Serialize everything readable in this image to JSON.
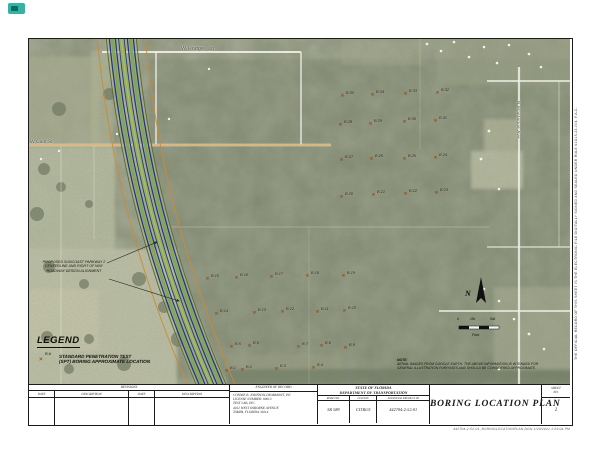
{
  "map": {
    "road_labels": {
      "top": "W Hodges Ln.",
      "left": "W Cain St",
      "right_vertical": "N Montague Ave"
    },
    "annotation": {
      "lines": [
        "PROPOSED SUNCOAST PARKWAY 2",
        "CENTERLINE AND RIGHT OF WAY",
        "ROADWAY DESIGN ALIGNMENT"
      ]
    },
    "legend": {
      "title": "LEGEND",
      "symbol_icon": "×",
      "symbol_label": "B-#",
      "desc_line1": "STANDARD PENETRATION TEST",
      "desc_line2": "(SPT) BORING APPROXIMATE LOCATION"
    },
    "north_label": "N",
    "scale_bar": {
      "ticks": [
        "0",
        "250",
        "500"
      ],
      "unit": "Feet"
    },
    "note": {
      "heading": "NOTE:",
      "line1": "AERIAL IMAGES FROM GOOGLE EARTH. THE ABOVE INFORMATION IS INTENDED FOR",
      "line2": "GENERAL ILLUSTRATION PURPOSES AND SHOULD BE CONSIDERED APPROXIMATE."
    },
    "colors": {
      "aerial_base": "#8a9078",
      "corridor_navy": "#27357c",
      "corridor_green": "#7ea45a",
      "right_of_way_orange": "#cd8a36",
      "marker_orange": "#a8571e"
    },
    "borings": [
      {
        "id": "B-1",
        "x": 198,
        "y": 333
      },
      {
        "id": "B-2",
        "x": 214,
        "y": 332
      },
      {
        "id": "B-3",
        "x": 248,
        "y": 331
      },
      {
        "id": "B-4",
        "x": 285,
        "y": 330
      },
      {
        "id": "B-5",
        "x": 203,
        "y": 309
      },
      {
        "id": "B-6",
        "x": 221,
        "y": 308
      },
      {
        "id": "B-7",
        "x": 270,
        "y": 309
      },
      {
        "id": "B-8",
        "x": 293,
        "y": 308
      },
      {
        "id": "B-9",
        "x": 317,
        "y": 310
      },
      {
        "id": "B-10",
        "x": 316,
        "y": 273
      },
      {
        "id": "B-11",
        "x": 289,
        "y": 274
      },
      {
        "id": "B-12",
        "x": 254,
        "y": 274
      },
      {
        "id": "B-13",
        "x": 226,
        "y": 275
      },
      {
        "id": "B-14",
        "x": 188,
        "y": 276
      },
      {
        "id": "B-15",
        "x": 179,
        "y": 241
      },
      {
        "id": "B-16",
        "x": 208,
        "y": 240
      },
      {
        "id": "B-17",
        "x": 243,
        "y": 239
      },
      {
        "id": "B-18",
        "x": 279,
        "y": 238
      },
      {
        "id": "B-19",
        "x": 315,
        "y": 238
      },
      {
        "id": "B-20",
        "x": 313,
        "y": 159
      },
      {
        "id": "B-21",
        "x": 345,
        "y": 157
      },
      {
        "id": "B-22",
        "x": 377,
        "y": 156
      },
      {
        "id": "B-23",
        "x": 408,
        "y": 155
      },
      {
        "id": "B-24",
        "x": 407,
        "y": 120
      },
      {
        "id": "B-25",
        "x": 376,
        "y": 121
      },
      {
        "id": "B-26",
        "x": 343,
        "y": 121
      },
      {
        "id": "B-27",
        "x": 313,
        "y": 122
      },
      {
        "id": "B-28",
        "x": 312,
        "y": 87
      },
      {
        "id": "B-29",
        "x": 342,
        "y": 86
      },
      {
        "id": "B-30",
        "x": 376,
        "y": 84
      },
      {
        "id": "B-31",
        "x": 407,
        "y": 83
      },
      {
        "id": "B-32",
        "x": 409,
        "y": 55
      },
      {
        "id": "B-33",
        "x": 377,
        "y": 56
      },
      {
        "id": "B-34",
        "x": 344,
        "y": 57
      },
      {
        "id": "B-35",
        "x": 314,
        "y": 58
      }
    ]
  },
  "title_block": {
    "revisions": {
      "title": "REVISIONS",
      "columns": [
        "DATE",
        "DESCRIPTION",
        "DATE",
        "DESCRIPTION"
      ]
    },
    "engineer": {
      "title": "ENGINEER OF RECORD",
      "lines": [
        "CONNIE B. JOHNSON-DEARMONT, P.E.",
        "LICENSE NUMBER: 69013",
        "TEST LAB, INC.",
        "4012 WEST OSBORNE AVENUE",
        "TAMPA, FLORIDA 33614"
      ]
    },
    "agency": {
      "state": "STATE OF FLORIDA",
      "department": "DEPARTMENT OF TRANSPORTATION",
      "fields": [
        {
          "label": "ROAD NO.",
          "value": "SR 589"
        },
        {
          "label": "COUNTY",
          "value": "CITRUS"
        },
        {
          "label": "FINANCIAL PROJECT ID",
          "value": "442704-2-52-01"
        }
      ]
    },
    "sheet_title": "BORING LOCATION PLAN",
    "sheet_no": {
      "label_line1": "SHEET",
      "label_line2": "NO.",
      "value": "1"
    }
  },
  "margins": {
    "right_vertical_note": "THE OFFICIAL RECORD OF THIS SHEET IS THE ELECTRONIC FILE DIGITALLY SIGNED AND SEALED UNDER RULE 61G15-23.004, F.A.C.",
    "plot_info": "442704-2-52-01_BORINGLOCATIONPLAN.DGN      1/28/2021      1:29:04 PM"
  }
}
